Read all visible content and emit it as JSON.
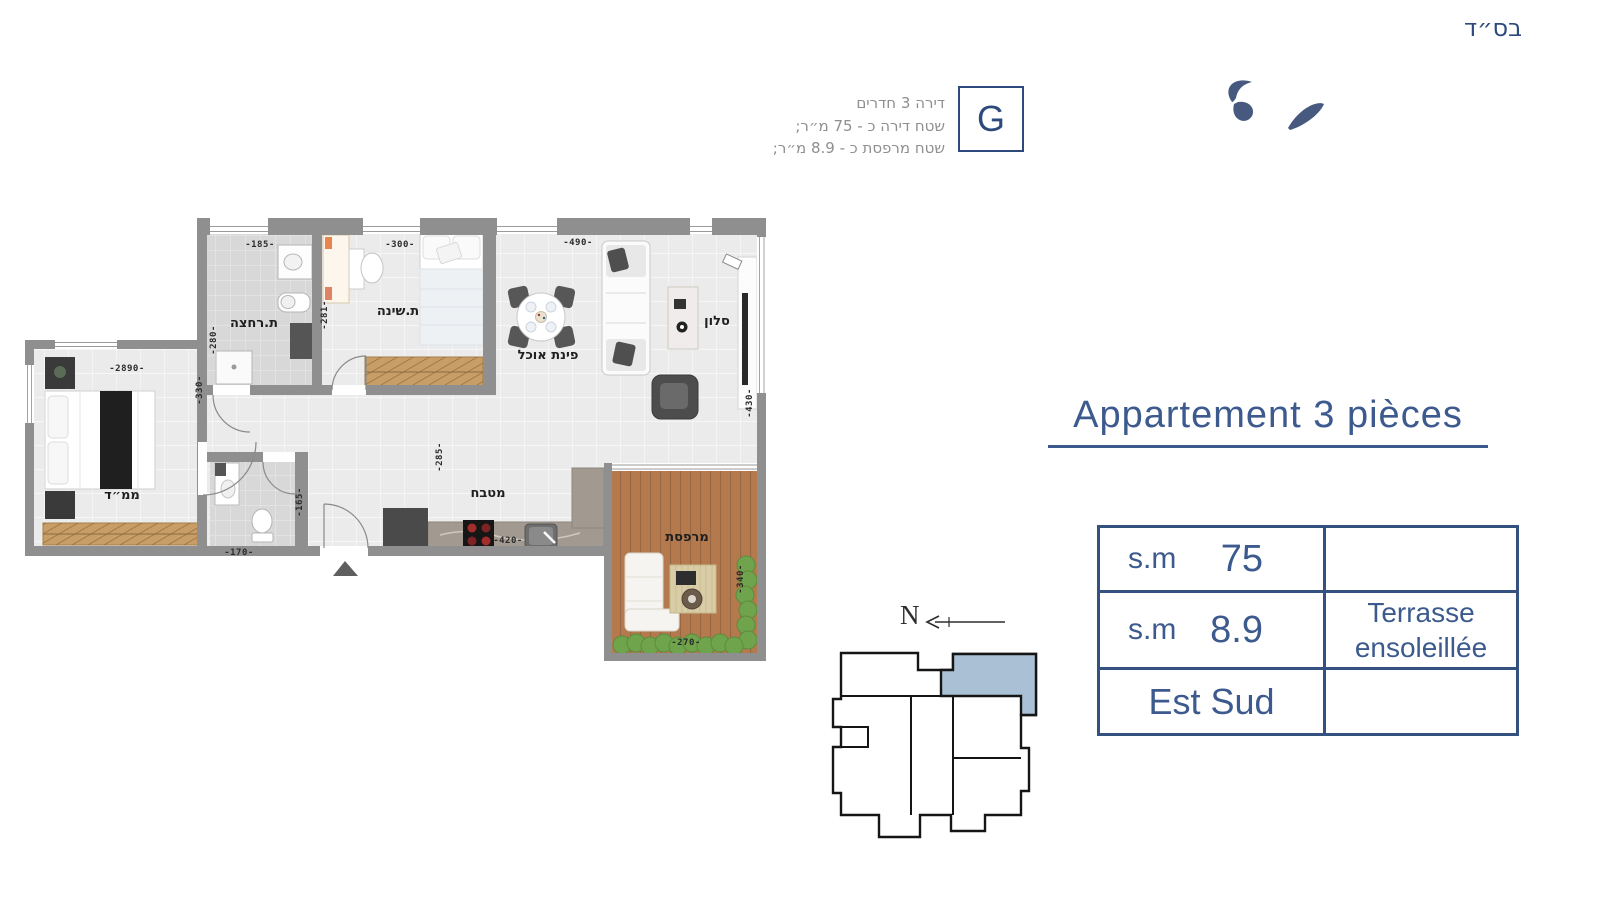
{
  "page": {
    "bsd": "בס״ד"
  },
  "header": {
    "unit_letter": "G",
    "info_lines": [
      "דירה 3 חדרים",
      "שטח דירה כ - 75 מ״ר;",
      "שטח מרפסת כ - 8.9 מ״ר;"
    ]
  },
  "title": {
    "text": "Appartement 3 pièces"
  },
  "spec_table": {
    "rows": [
      {
        "label": "s.m",
        "value": "75",
        "note": ""
      },
      {
        "label": "s.m",
        "value": "8.9",
        "note": "Terrasse ensoleillée"
      },
      {
        "label": "Est Sud",
        "value": "",
        "note": ""
      }
    ]
  },
  "compass": {
    "label": "N"
  },
  "plan": {
    "rooms": [
      {
        "name": "bathroom",
        "label": "ת.רחצה"
      },
      {
        "name": "bedroom",
        "label": "ת.שינה"
      },
      {
        "name": "dining",
        "label": "פינת אוכל"
      },
      {
        "name": "living",
        "label": "סלון"
      },
      {
        "name": "kitchen",
        "label": "מטבח"
      },
      {
        "name": "safe-room",
        "label": "ממ״ד"
      },
      {
        "name": "balcony",
        "label": "מרפסת"
      }
    ],
    "dimensions": [
      {
        "text": "-185-"
      },
      {
        "text": "-300-"
      },
      {
        "text": "-490-"
      },
      {
        "text": "-280-"
      },
      {
        "text": "-281-"
      },
      {
        "text": "-330-"
      },
      {
        "text": "-2890-"
      },
      {
        "text": "-285-"
      },
      {
        "text": "-420-"
      },
      {
        "text": "-170-"
      },
      {
        "text": "-165-"
      },
      {
        "text": "-430-"
      },
      {
        "text": "-340-"
      },
      {
        "text": "-270-"
      }
    ]
  },
  "colors": {
    "accent_blue": "#3c5a8e",
    "table_border": "#34517f",
    "highlight_unit_fill": "#a9c0d5",
    "wall_gray": "#8f8f8f",
    "info_gray": "#8f8f8f",
    "balcony_wood": "#b47a4d",
    "hedge_green": "#6fa34c"
  }
}
